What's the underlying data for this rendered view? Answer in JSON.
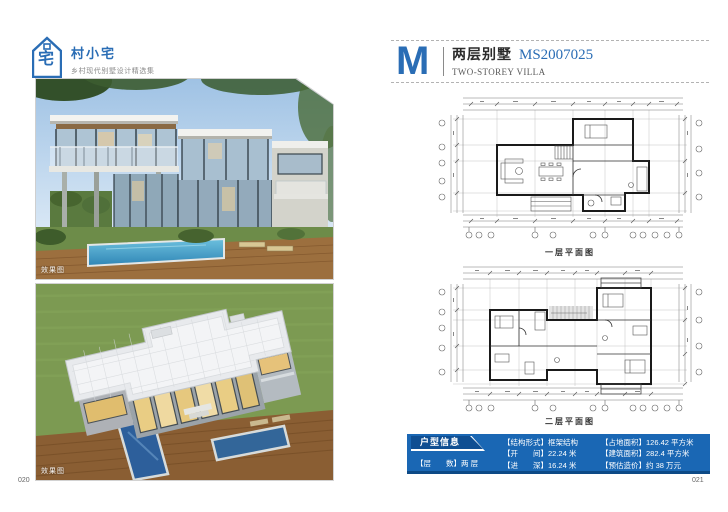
{
  "brand": {
    "title": "村小宅",
    "subtitle": "乡村现代别墅设计精选集",
    "logo_glyph": "宅"
  },
  "left_page": {
    "page_number": "020",
    "render_label_1": "效果图",
    "render_label_2": "效果图"
  },
  "right_page": {
    "page_number": "021",
    "header": {
      "logo_letter": "M",
      "title_cn": "两层别墅",
      "model_code": "MS2007025",
      "title_en": "TWO-STOREY VILLA"
    },
    "plans": {
      "first_caption": "一层平面图",
      "second_caption": "二层平面图"
    },
    "info": {
      "tab": "户型信息",
      "floors": "【层　　数】两 层",
      "structure": "【结构形式】框架结构",
      "bay_width": "【开　　间】22.24 米",
      "depth": "【进　　深】16.24 米",
      "land_area": "【占地面积】126.42 平方米",
      "building_area": "【建筑面积】282.4 平方米",
      "estimated_cost": "【预估造价】约 38 万元"
    }
  },
  "colors": {
    "brand_blue": "#2a6db5",
    "info_box_blue": "#1a67b4",
    "info_tab_blue": "#0f4e92",
    "plan_line": "#1a1a1a"
  }
}
